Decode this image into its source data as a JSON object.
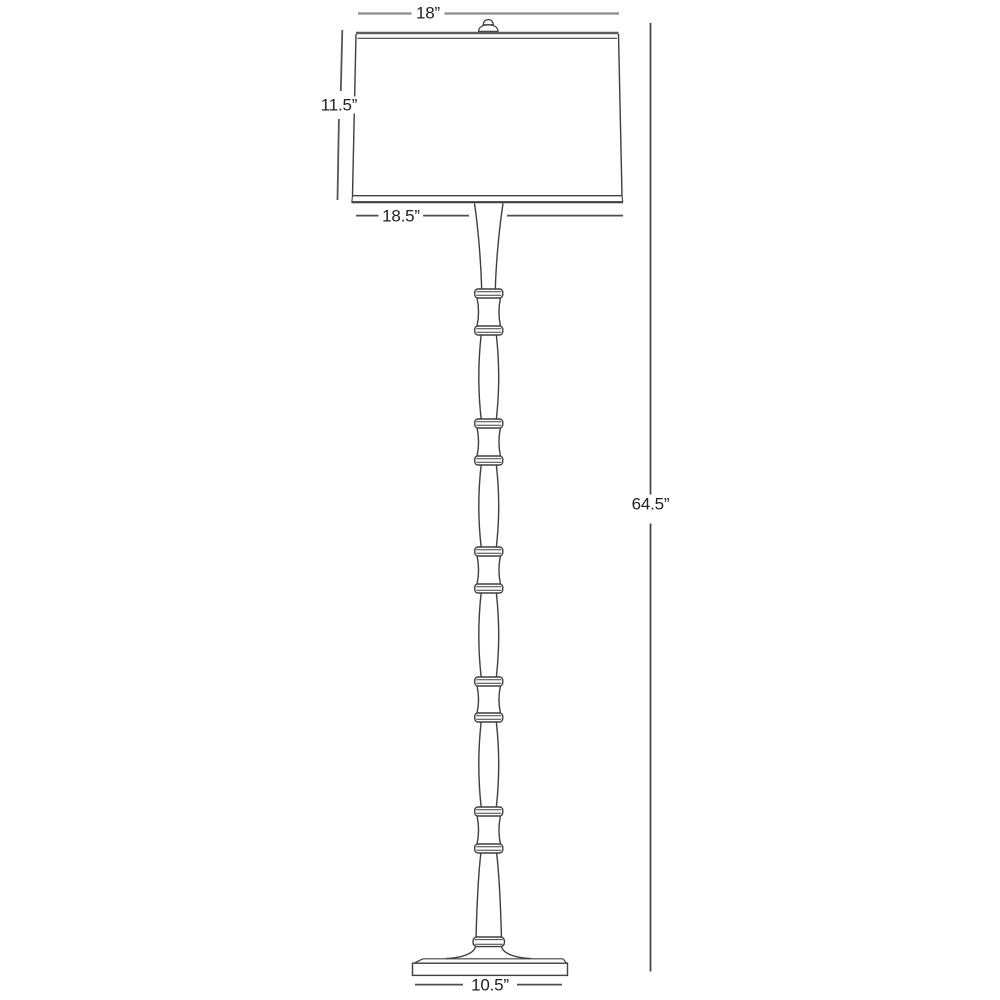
{
  "diagram": {
    "type": "product-dimension-line-drawing",
    "subject": "bamboo-style floor lamp with drum shade",
    "dimensions": {
      "shade_top_width": "18”",
      "shade_height": "11.5”",
      "shade_bottom_width": "18.5”",
      "overall_height": "64.5”",
      "base_width": "10.5”"
    },
    "colors": {
      "background": "#ffffff",
      "lamp_line": "#3e3f41",
      "dimension_line": "#4d4e50",
      "dimension_line_light": "#8a8c8f",
      "text": "#231f20"
    }
  }
}
